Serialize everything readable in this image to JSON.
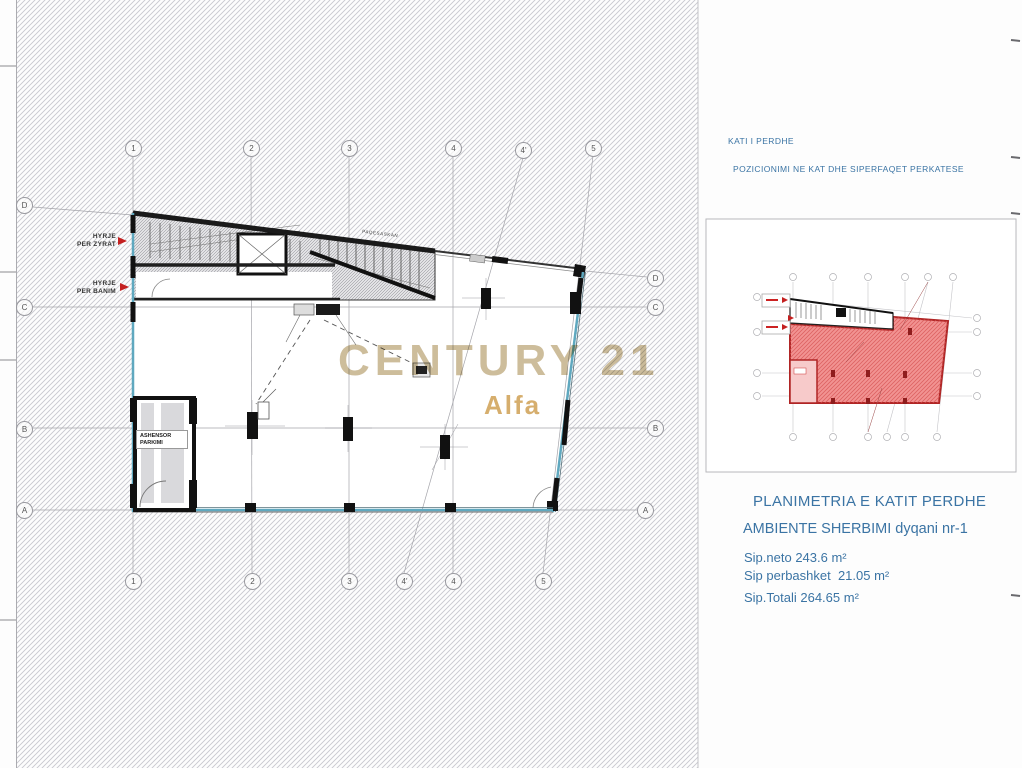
{
  "panel": {
    "kati": "KATI I PERDHE",
    "pozicionimi": "POZICIONIMI NE KAT DHE SIPERFAQET PERKATESE",
    "title": "PLANIMETRIA E KATIT PERDHE",
    "subtitle": "AMBIENTE SHERBIMI dyqani nr-1",
    "sip_neto": "Sip.neto 243.6 m²",
    "sip_perbashket": "Sip perbashket  21.05 m²",
    "sip_totali": "Sip.Totali 264.65 m²"
  },
  "watermark": {
    "line1": "CENTURY 21",
    "line2": "Alfa"
  },
  "plan": {
    "labels": {
      "hyrje_zyrat": [
        "HYRJE",
        "PER ZYRAT"
      ],
      "hyrje_banim": [
        "HYRJE",
        "PER BANIM"
      ],
      "ashensor": [
        "ASHENSOR",
        "PARKIMI"
      ],
      "micro": "PAQESASKAN"
    },
    "grid_bubbles": [
      {
        "x": 133,
        "y": 148,
        "label": "1"
      },
      {
        "x": 251,
        "y": 148,
        "label": "2"
      },
      {
        "x": 349,
        "y": 148,
        "label": "3"
      },
      {
        "x": 453,
        "y": 148,
        "label": "4"
      },
      {
        "x": 523,
        "y": 150,
        "label": "4'"
      },
      {
        "x": 593,
        "y": 148,
        "label": "5"
      },
      {
        "x": 133,
        "y": 581,
        "label": "1"
      },
      {
        "x": 252,
        "y": 581,
        "label": "2"
      },
      {
        "x": 349,
        "y": 581,
        "label": "3"
      },
      {
        "x": 404,
        "y": 581,
        "label": "4'"
      },
      {
        "x": 453,
        "y": 581,
        "label": "4"
      },
      {
        "x": 543,
        "y": 581,
        "label": "5"
      },
      {
        "x": 24,
        "y": 205,
        "label": "D"
      },
      {
        "x": 24,
        "y": 307,
        "label": "C"
      },
      {
        "x": 24,
        "y": 429,
        "label": "B"
      },
      {
        "x": 24,
        "y": 510,
        "label": "A"
      },
      {
        "x": 655,
        "y": 278,
        "label": "D"
      },
      {
        "x": 655,
        "y": 307,
        "label": "C"
      },
      {
        "x": 655,
        "y": 428,
        "label": "B"
      },
      {
        "x": 645,
        "y": 510,
        "label": "A"
      }
    ]
  },
  "colors": {
    "accent_blue": "#3b74a4",
    "entry_red": "#c42020",
    "highlight_red": "#f29392",
    "highlight_border": "#b02525",
    "facade_teal": "#5fa8bf",
    "watermark_tan": "#cdbd9b"
  }
}
